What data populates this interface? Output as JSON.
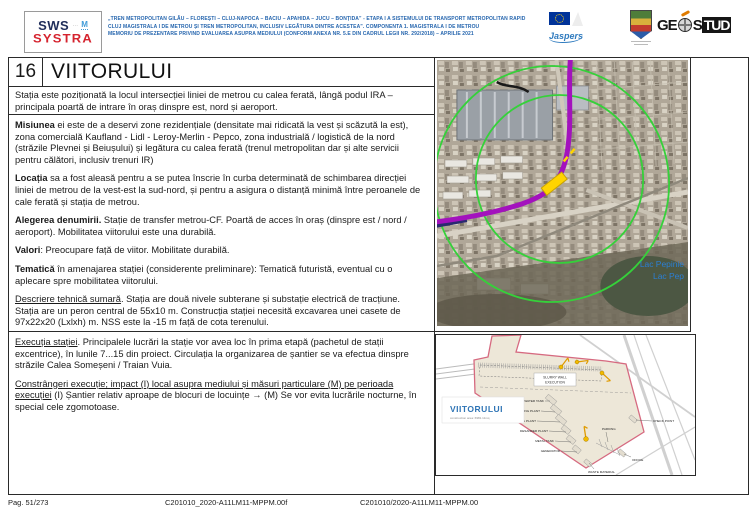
{
  "header": {
    "logo": {
      "line1": "SWS",
      "m": "M",
      "line2": "SYSTRA"
    },
    "doc_title_lines": [
      "„TREN METROPOLITAN GILĂU – FLOREȘTI – CLUJ-NAPOCA – BACIU – APAHIDA – JUCU – BONȚIDA” - ETAPA I A SISTEMULUI DE TRANSPORT METROPOLITAN RAPID",
      "CLUJ MAGISTRALA I DE METROU ȘI TREN METROPOLITAN, INCLUSIV LEGĂTURA DINTRE ACESTEA”. COMPONENTA 1. MAGISTRALA I DE METROU",
      "MEMORIU DE PREZENTARE PRIVIND EVALUAREA ASUPRA MEDIULUI (CONFORM ANEXA NR. 5.E DIN CADRUL LEGII NR. 292/2018) – APRILIE 2021"
    ],
    "jaspers_label": "Jaspers",
    "geostud": {
      "ge": "GE",
      "s": "S",
      "tud": "TUD"
    }
  },
  "station": {
    "number": "16",
    "name": "VIITORULUI"
  },
  "sections": {
    "intro": [
      [
        {
          "t": "Stația este poziționată la locul intersecției liniei de metrou cu calea ferată, lângă podul IRA – principala poartă de intrare în oraș dinspre est, nord și aeroport."
        }
      ]
    ],
    "main": [
      [
        {
          "t": "Misiunea",
          "b": 1
        },
        {
          "t": " ei este de a deservi zone rezidențiale (densitate mai ridicată la vest și scăzută la est), zona comercială Kaufland - Lidl - Leroy-Merlin - Pepco, zona industrială / logistică de la nord (străzile Plevnei și Beiușului) și legătura cu calea ferată (trenul metropolitan dar și alte servicii pentru călători, inclusiv trenuri IR)"
        }
      ],
      [
        {
          "t": "Locația",
          "b": 1
        },
        {
          "t": " sa a fost aleasă pentru a se putea înscrie în curba determinată de schimbarea direcției liniei de metrou de la vest-est la sud-nord, și pentru a asigura o distanță minimă între peroanele de cale ferată și stația de metrou."
        }
      ],
      [
        {
          "t": "Alegerea denumirii.",
          "b": 1
        },
        {
          "t": " Stație de transfer metrou-CF. Poartă de acces în oraș (dinspre est / nord / aeroport). Mobilitatea viitorului este una durabilă."
        }
      ],
      [
        {
          "t": "Valori",
          "b": 1
        },
        {
          "t": ": Preocupare față de viitor. Mobilitate durabilă."
        }
      ],
      [
        {
          "t": "Tematică",
          "b": 1
        },
        {
          "t": " în amenajarea stației (considerente preliminare): Tematică futuristă, eventual cu o aplecare spre mobilitatea viitorului."
        }
      ],
      [
        {
          "t": "Descriere tehnică sumară",
          "u": 1
        },
        {
          "t": ". Stația are două nivele subterane și substație electrică de tracțiune. Stația are un peron central de 55x10 m. Construcția stației necesită excavarea unei casete de 97x22x20 (Lxlxh) m. NSS este la -15 m față de cota terenului."
        }
      ]
    ],
    "execution": [
      [
        {
          "t": "Execuția stației",
          "u": 1
        },
        {
          "t": ". Principalele lucrări la stație vor avea loc în prima etapă (pachetul de stații excentrice), în lunile 7...15 din proiect. Circulația la organizarea de șantier se va efectua dinspre străzile Calea Someșeni / Traian Vuia."
        }
      ],
      [
        {
          "t": "Constrângeri execuție; impact (I) local asupra mediului și măsuri particulare (M) pe perioada execuției",
          "u": 1
        },
        {
          "t": " (I) Șantier relativ aproape de blocuri de locuințe → (M) Se vor evita lucrările nocturne, în special cele zgomotoase."
        }
      ]
    ]
  },
  "map": {
    "lake_label_1": "Lac Pepinie",
    "lake_label_2": "Lac Pep",
    "colors": {
      "radius_circle": "#35d13a",
      "metro_line": "#a312bd",
      "station_marker": "#ffd400",
      "lake_label": "#2b7fd4"
    }
  },
  "site_plan": {
    "title": "VIITORULUI",
    "subtitle": "construction area: 6981.11mq",
    "colors": {
      "boundary": "#d66a80",
      "title": "#2e74b5",
      "equipment": "#f2bb00"
    },
    "labels": {
      "slurry1": "SLURRY WALL",
      "slurry2": "EXECUTION",
      "water_tank": "WATER TANK",
      "mixing_plant": "MIXING PLANT",
      "bentonite_plant": "BENTONITE PLANT",
      "desander_plant": "DESANDER PLANT",
      "metal_tank": "METAL TANK",
      "generator": "GENERATOR",
      "waste_material": "WASTE MATERIAL",
      "parking": "PARKING",
      "office": "OFFICE",
      "check_point": "CHECK POINT"
    }
  },
  "footer": {
    "page_label": "Pag. 51/273",
    "code_left": "C201010_2020-A11LM11-MPPM.00f",
    "code_right": "C201010/2020-A11LM11-MPPM.00"
  }
}
